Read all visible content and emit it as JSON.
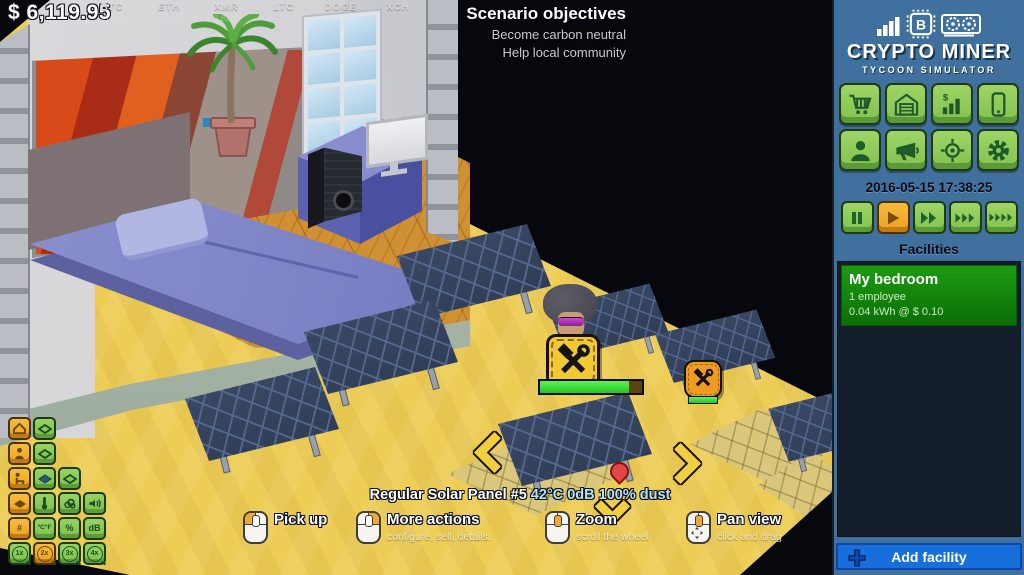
{
  "colors": {
    "sidebar": "#40719e",
    "button_green": "#8fcb58",
    "button_orange": "#f0a832",
    "add_facility_blue": "#176fdb",
    "facility_green": "#128a0a",
    "sand": "#edcd55",
    "panel_blue": "#35425c"
  },
  "hud": {
    "money": "$ 6,119.95",
    "ticker": [
      {
        "symbol": "BTC",
        "value": "454.13"
      },
      {
        "symbol": "ETH",
        "value": "11.79"
      },
      {
        "symbol": "XMR",
        "value": "0.8209"
      },
      {
        "symbol": "LTC",
        "value": ""
      },
      {
        "symbol": "DOGE",
        "value": ""
      },
      {
        "symbol": "XCH",
        "value": ""
      }
    ],
    "objectives": {
      "title": "Scenario objectives",
      "items": [
        "Become carbon neutral",
        "Help local community"
      ]
    }
  },
  "selection": {
    "label": "Regular Solar Panel #5",
    "stats": "42°C 0dB 100% dust",
    "repair_progress_pct": 87,
    "secondary_progress_pct": 100
  },
  "legend": {
    "items": [
      {
        "label": "Pick up",
        "sub": ""
      },
      {
        "label": "More actions",
        "sub": "configure, sell, details."
      },
      {
        "label": "Zoom",
        "sub": "scroll the wheel"
      },
      {
        "label": "Pan view",
        "sub": "click and drag"
      }
    ]
  },
  "toolgrid": {
    "labels": {
      "count": "#",
      "temp": "°C°F",
      "percent": "%",
      "noise": "dB",
      "z1": "1x",
      "z2": "2x",
      "z3": "3x",
      "z4": "4x"
    }
  },
  "sidebar": {
    "logo": {
      "title": "CRYPTO MINER",
      "subtitle": "TYCOON SIMULATOR"
    },
    "datetime": "2016-05-15 17:38:25",
    "facilities": {
      "title": "Facilities",
      "items": [
        {
          "name": "My bedroom",
          "employees": "1 employee",
          "power": "0.04 kWh @ $ 0.10"
        }
      ]
    },
    "add_facility_label": "Add facility"
  },
  "icons": {
    "logo": [
      "bar-chart-icon",
      "chip-b-icon",
      "gpu-icon"
    ],
    "menu": [
      "cart-icon",
      "warehouse-icon",
      "market-chart-icon",
      "phone-icon",
      "person-icon",
      "megaphone-icon",
      "target-icon",
      "gear-icon"
    ],
    "speed": [
      "pause-icon",
      "play-icon",
      "ff2-icon",
      "ff3-icon",
      "ff4-icon"
    ],
    "toolgrid": [
      "roof-icon",
      "diamond-outline-icon",
      "person-icon",
      "seat-icon",
      "diamond-dark-icon",
      "diamond-filled-icon",
      "thermometer-icon",
      "co2-cloud-icon",
      "speaker-icon"
    ],
    "misc": [
      "repair-tools-icon",
      "mouse-left-icon",
      "mouse-right-icon",
      "mouse-wheel-icon",
      "pan-arrows-icon",
      "plus-icon",
      "map-pin-icon",
      "chevron-left-icon",
      "chevron-right-icon",
      "chevron-down-icon"
    ]
  }
}
